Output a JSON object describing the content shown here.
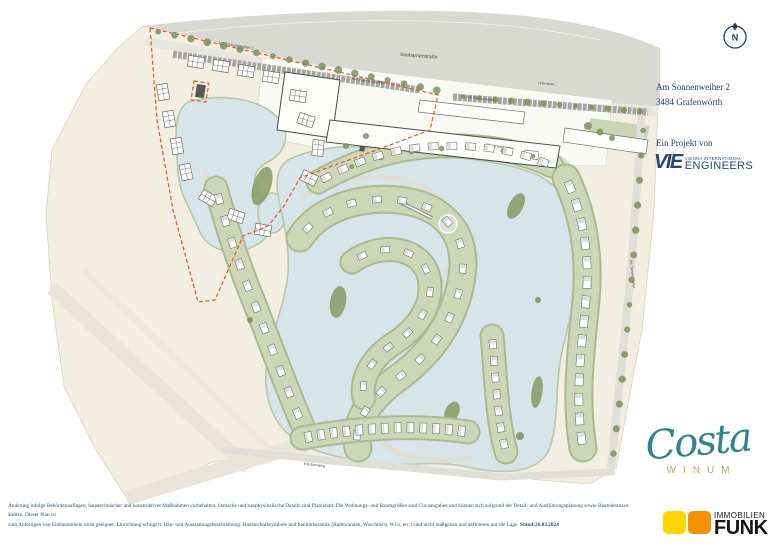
{
  "colors": {
    "navy": "#1F3B6B",
    "teal": "#2F8494",
    "gold": "#C9A053",
    "funk_yellow": "#FFD400",
    "funk_orange": "#F29100",
    "boundary_red": "#E0562A",
    "water": "#D7E5EB",
    "green_band": "#CDD6B6",
    "land": "#F2EEE1",
    "road": "#D9D9D3"
  },
  "compass": {
    "label": "N"
  },
  "map": {
    "labels": {
      "seebarnerstrasse": "Seebarnerstraße",
      "am_sonnenweiher_2": "Am Sonnenweiher 2",
      "am_sonnenweiher_a": "Am Sonnenweiher",
      "am_sonnenweiher_b": "Am Sonnenweiher",
      "am_sonnenweiher_c": "Am Sonnenweiher",
      "lindenallee": "Lindenallee",
      "seepromenade": "Seepromenade",
      "kirchenweg": "Kirchenweg"
    }
  },
  "info_panel": {
    "address_line1": "Am Sonnenweiher 2",
    "address_line2": "3484 Grafenwörth",
    "project_label": "Ein Projekt von",
    "vie": {
      "acronym": "VIE",
      "top": "VIENNA INTERNATIONAL",
      "bottom": "ENGINEERS"
    }
  },
  "brand": {
    "name": "Costa",
    "sub": "WINUM"
  },
  "broker": {
    "top": "IMMOBILIEN",
    "bottom": "FUNK"
  },
  "disclaimer": {
    "line1": "Änderung infolge Behördenauflagen, haustechnischer und konstruktiver Maßnahmen vorbehalten. Statische und bauphysikalische Details sind Planinhalt. Die Wohnungs- und Raumgrößen sind Circaangaben und können sich aufgrund der Detail- und Ausführungsplanung sowie Bautoleranzen ändern. Dieser Plan ist",
    "line2": "zum Anfertigen von Einbaumöbeln nicht geeignet. Einrichtung erfolgt lt. Bau- und Ausstattungsbeschreibung. Haustechniksymbole und Sanitärkeramik (Badewannen, Waschtisch, WCs, etc.) sind nicht maßgenau und definieren nur die Lage.",
    "stand": "Stand:26.02.2024"
  }
}
